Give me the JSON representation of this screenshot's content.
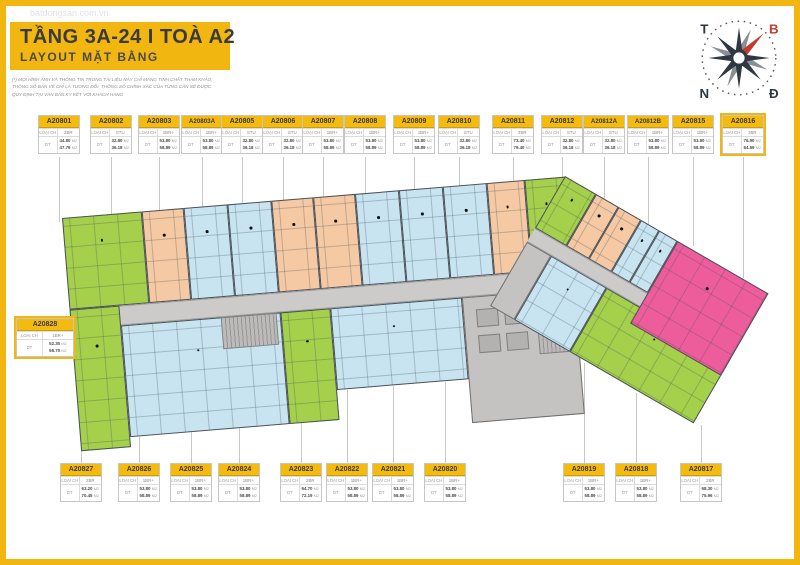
{
  "page": {
    "title": "TẦNG 3A-24 I TOÀ A2",
    "subtitle": "LAYOUT MẶT BẰNG",
    "watermark": "batdongsan.com.vn",
    "disclaimer_lines": [
      "(*) MỌI HÌNH ẢNH VÀ THÔNG TIN TRONG TÀI LIỆU NÀY CHỈ MANG TÍNH CHẤT THAM KHẢO,",
      "THÔNG SỐ BẢN VẼ CHỈ LÀ TƯƠNG ĐỐI, THÔNG SỐ CHÍNH XÁC CỦA TỪNG CĂN SẼ ĐƯỢC",
      "QUY ĐỊNH TẠI VĂN BẢN KÝ KẾT VỚI KHÁCH HÀNG"
    ]
  },
  "labels": {
    "type_label": "LOẠI CH",
    "area_label": "DT",
    "area_unit": "M2"
  },
  "compass": {
    "top_left": "T",
    "top_right": "B",
    "bottom_left": "N",
    "bottom_right": "Đ",
    "needle_color": "#c23b2e",
    "rose_color": "#2e3742"
  },
  "colors": {
    "green": "#a5d04c",
    "blue": "#c7e4f0",
    "orange": "#f5c9a3",
    "pink": "#ee5d9b",
    "corridor": "#cccbca",
    "core": "#c5c3c1",
    "accent_yellow": "#f2b611"
  },
  "units_top": [
    {
      "id": "A20801",
      "type": "2BR",
      "area1": "44.80",
      "area2": "47.79",
      "color": "green"
    },
    {
      "id": "A20802",
      "type": "STU",
      "area1": "32.80",
      "area2": "36.18",
      "color": "orange"
    },
    {
      "id": "A20803",
      "type": "1BR+",
      "area1": "53.80",
      "area2": "58.89",
      "color": "blue"
    },
    {
      "id": "A20803A",
      "type": "1BR+",
      "area1": "53.80",
      "area2": "58.89",
      "color": "blue"
    },
    {
      "id": "A20805",
      "type": "STU",
      "area1": "32.80",
      "area2": "36.18",
      "color": "orange"
    },
    {
      "id": "A20806",
      "type": "STU",
      "area1": "32.80",
      "area2": "36.18",
      "color": "orange"
    },
    {
      "id": "A20807",
      "type": "1BR+",
      "area1": "53.80",
      "area2": "58.89",
      "color": "blue"
    },
    {
      "id": "A20808",
      "type": "1BR+",
      "area1": "53.80",
      "area2": "58.89",
      "color": "blue"
    },
    {
      "id": "A20809",
      "type": "1BR+",
      "area1": "53.80",
      "area2": "58.89",
      "color": "blue"
    },
    {
      "id": "A20810",
      "type": "STU",
      "area1": "32.80",
      "area2": "36.18",
      "color": "orange"
    },
    {
      "id": "A20811",
      "type": "2BR",
      "area1": "73.40",
      "area2": "79.40",
      "color": "green"
    },
    {
      "id": "A20812",
      "type": "STU",
      "area1": "32.80",
      "area2": "36.18",
      "color": "orange"
    },
    {
      "id": "A20812A",
      "type": "STU",
      "area1": "32.80",
      "area2": "36.18",
      "color": "orange"
    },
    {
      "id": "A20812B",
      "type": "1BR+",
      "area1": "53.80",
      "area2": "58.89",
      "color": "blue"
    },
    {
      "id": "A20815",
      "type": "1BR+",
      "area1": "53.80",
      "area2": "58.89",
      "color": "blue"
    },
    {
      "id": "A20816",
      "type": "3BR",
      "area1": "76.90",
      "area2": "84.69",
      "color": "pink",
      "highlight": true
    }
  ],
  "unit_left": {
    "id": "A20828",
    "type": "1BR+",
    "area1": "52.30",
    "area2": "56.70",
    "color": "green",
    "highlight": true
  },
  "units_bottom": [
    {
      "id": "A20827",
      "type": "2BR",
      "area1": "63.20",
      "area2": "70.45",
      "color": "green"
    },
    {
      "id": "A20826",
      "type": "1BR+",
      "area1": "53.80",
      "area2": "58.89",
      "color": "blue"
    },
    {
      "id": "A20825",
      "type": "1BR+",
      "area1": "53.80",
      "area2": "58.89",
      "color": "blue"
    },
    {
      "id": "A20824",
      "type": "1BR+",
      "area1": "53.80",
      "area2": "58.89",
      "color": "blue"
    },
    {
      "id": "A20823",
      "type": "2BR",
      "area1": "64.70",
      "area2": "72.19",
      "color": "green"
    },
    {
      "id": "A20822",
      "type": "1BR+",
      "area1": "53.80",
      "area2": "58.89",
      "color": "blue"
    },
    {
      "id": "A20821",
      "type": "1BR+",
      "area1": "53.80",
      "area2": "58.89",
      "color": "blue"
    },
    {
      "id": "A20820",
      "type": "1BR+",
      "area1": "53.80",
      "area2": "58.89",
      "color": "blue"
    },
    {
      "id": "A20819",
      "type": "1BR+",
      "area1": "53.80",
      "area2": "58.89",
      "color": "blue"
    },
    {
      "id": "A20818",
      "type": "1BR+",
      "area1": "53.80",
      "area2": "58.89",
      "color": "blue"
    },
    {
      "id": "A20817",
      "type": "2BR",
      "area1": "68.30",
      "area2": "75.96",
      "color": "green"
    }
  ]
}
